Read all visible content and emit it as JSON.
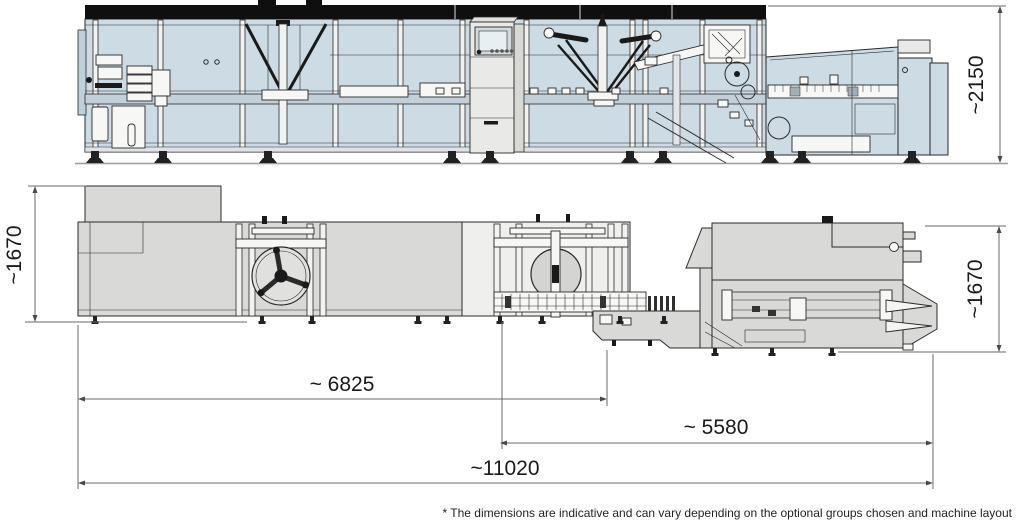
{
  "document": {
    "type": "technical-drawing",
    "subject": "packaging machine layout with side elevation (top) and plan view (bottom)"
  },
  "dimensions": {
    "height": "~2150",
    "side_left": "~1670",
    "side_right": "~1670",
    "length_main": "~ 6825",
    "length_right": "~ 5580",
    "length_total": "~11020"
  },
  "footnote": "* The dimensions are indicative and can vary depending on the optional groups chosen and machine layout",
  "colors": {
    "panel_blue": "#ccdbe4",
    "panel_gray": "#d9d9d7",
    "cabinet_gray": "#e9e9e7",
    "outline": "#2a2a2a",
    "dimension_line": "#6a6a6a",
    "top_bar": "#0f0f0f",
    "background": "#ffffff"
  },
  "views": [
    {
      "name": "side-elevation",
      "position": "top"
    },
    {
      "name": "plan",
      "position": "bottom"
    }
  ]
}
